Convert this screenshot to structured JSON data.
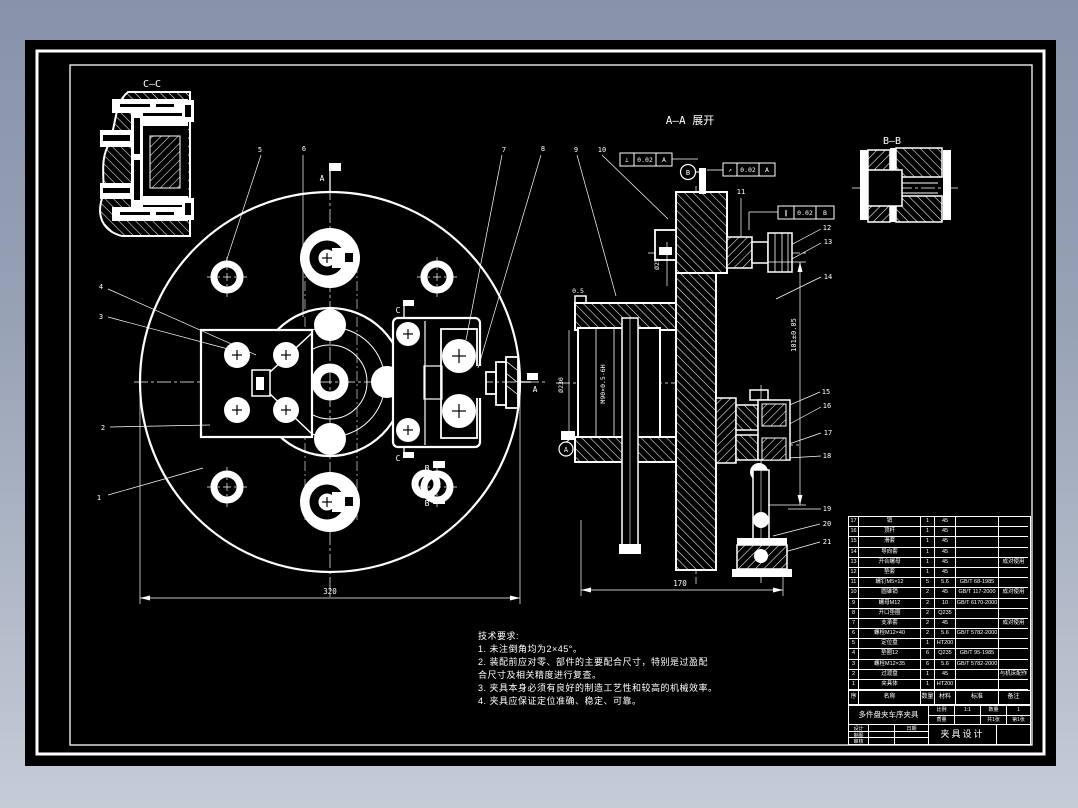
{
  "colors": {
    "bg_top": "#8793aa",
    "bg_bottom": "#c6ccd7",
    "sheet": "#000000",
    "line": "#ffffff"
  },
  "views": {
    "cc_title": "C—C",
    "aa_title": "A—A 展开",
    "bb_title": "B—B"
  },
  "markers": {
    "a": "A",
    "b": "B",
    "c": "C"
  },
  "callouts": [
    "1",
    "2",
    "3",
    "4",
    "5",
    "6",
    "7",
    "8",
    "9",
    "10",
    "11",
    "12",
    "13",
    "14",
    "15",
    "16",
    "17",
    "18",
    "19",
    "20",
    "21"
  ],
  "dimensions": {
    "width": "320",
    "depth": "170",
    "height": "101±0.05",
    "bore": "Ø25",
    "od": "Ø230",
    "thread": "M90×0.5-6H",
    "chamfer": "0.5"
  },
  "gdt": {
    "f1": {
      "sym": "⊥",
      "tol": "0.02",
      "datum": "A"
    },
    "f2": {
      "sym": "↗",
      "tol": "0.02",
      "datum": "A"
    },
    "f3": {
      "sym": "∥",
      "tol": "0.02",
      "datum": "B"
    }
  },
  "notes": {
    "title": "技术要求:",
    "lines": [
      "1. 未注倒角均为2×45°。",
      "2. 装配前应对零、部件的主要配合尺寸，特别是过盈配",
      "合尺寸及相关精度进行复查。",
      "3. 夹具本身必须有良好的制造工艺性和较高的机械效率。",
      "4. 夹具应保证定位准确、稳定、可靠。"
    ]
  },
  "bom": {
    "headers": [
      "序号",
      "名称",
      "数量",
      "材料",
      "标准",
      "备注"
    ],
    "rows": [
      [
        "17",
        "销",
        "1",
        "45",
        "",
        ""
      ],
      [
        "16",
        "顶杆",
        "1",
        "45",
        "",
        ""
      ],
      [
        "15",
        "滑套",
        "1",
        "45",
        "",
        ""
      ],
      [
        "14",
        "导向套",
        "1",
        "45",
        "",
        ""
      ],
      [
        "13",
        "开合螺母",
        "1",
        "45",
        "",
        "成对使用"
      ],
      [
        "12",
        "垫套",
        "1",
        "45",
        "",
        ""
      ],
      [
        "11",
        "螺钉M5×12",
        "5",
        "5.6",
        "GB/T 68-1985",
        ""
      ],
      [
        "10",
        "圆锥销",
        "2",
        "45",
        "GB/T 117-2000",
        "成对使用"
      ],
      [
        "9",
        "螺母M12",
        "2",
        "10",
        "GB/T 6170-2000",
        ""
      ],
      [
        "8",
        "开口垫圈",
        "2",
        "Q235",
        "",
        ""
      ],
      [
        "7",
        "支承套",
        "2",
        "45",
        "",
        "成对使用"
      ],
      [
        "6",
        "螺栓M12×40",
        "2",
        "5.6",
        "GB/T 5782-2000",
        ""
      ],
      [
        "5",
        "定位盘",
        "1",
        "HT200",
        "",
        ""
      ],
      [
        "4",
        "垫圈12",
        "6",
        "Q235",
        "GB/T 95-1985",
        ""
      ],
      [
        "3",
        "螺栓M12×35",
        "6",
        "5.6",
        "GB/T 5782-2000",
        ""
      ],
      [
        "2",
        "过渡盘",
        "1",
        "45",
        "",
        "与机床配作"
      ],
      [
        "1",
        "夹具体",
        "1",
        "HT200",
        "",
        ""
      ]
    ]
  },
  "titleblock": {
    "product": "多件盘夹车序夹具",
    "title": "夹具设计",
    "grid": {
      "r1": [
        "比例",
        "1:1",
        "数量",
        "1"
      ],
      "r2": [
        "质量",
        "",
        "共1张",
        "第1张"
      ]
    },
    "sign": {
      "r1": [
        "设计",
        "",
        "日期"
      ],
      "r2": [
        "制图",
        "",
        ""
      ],
      "r3": [
        "审核",
        "",
        ""
      ]
    }
  }
}
